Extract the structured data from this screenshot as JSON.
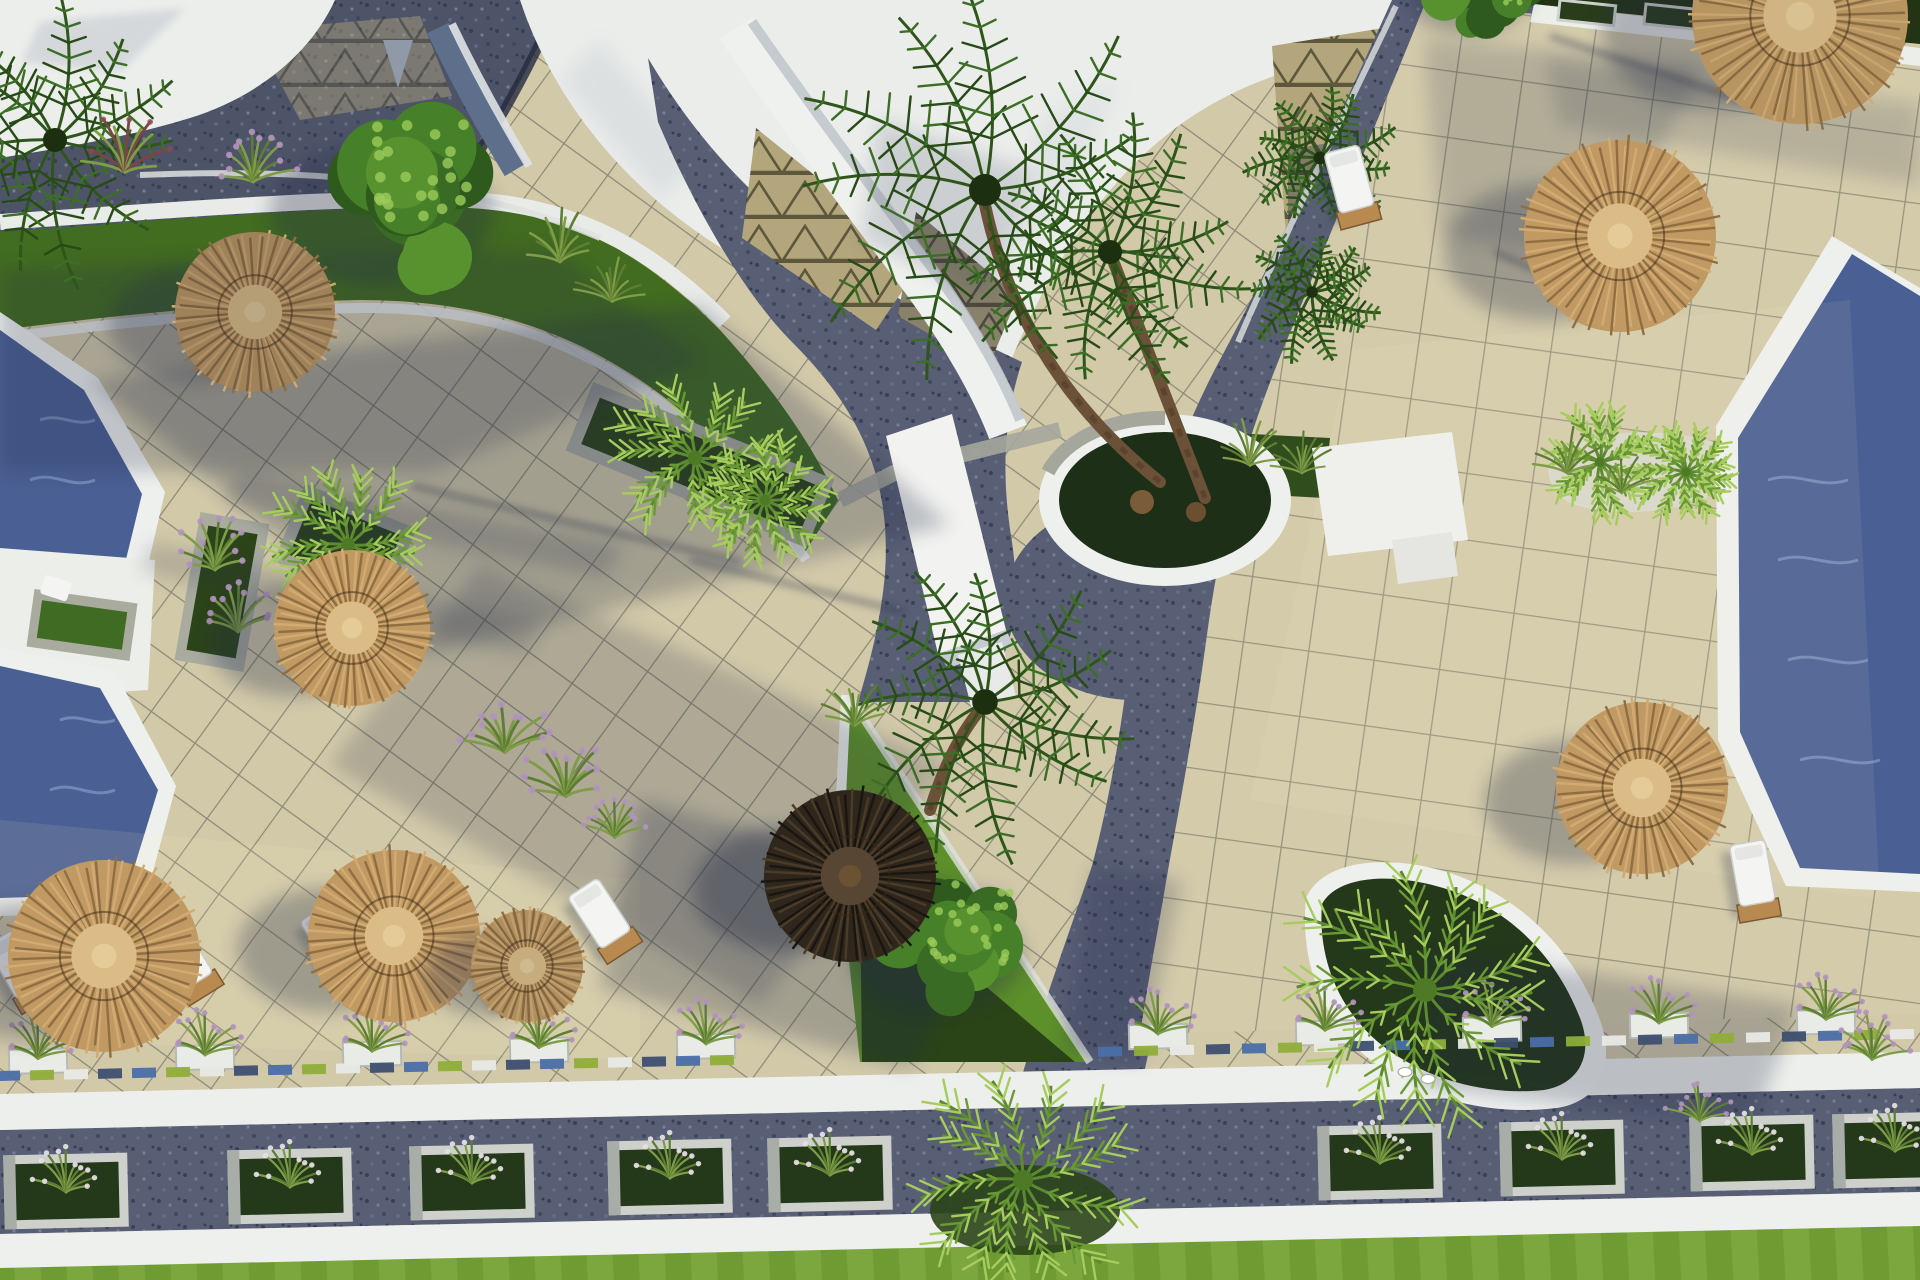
{
  "scene": {
    "type": "aerial-3d-render",
    "description": "Top-down 3D rendering of a resort courtyard with swimming pools, straw parasols, sun loungers, palm trees, planters, beige tiled terraces, dark stone pathways, white curbs and green lawns in low sunlight with long shadows",
    "lighting": "low sun from upper right, long shadows to lower left"
  },
  "colors": {
    "paving": "#d2c9a9",
    "paving_right": "#d4cbab",
    "grid_line": "#5c6052",
    "path": "#585f75",
    "path_deep": "#4e5468",
    "white": "#f1f2ef",
    "white_dim": "#eceee9",
    "white_shade": "#bcc2c8",
    "lawn": "#74a234",
    "lawn_dark": "#426c20",
    "planter_green": "#24381a",
    "bright_green": "#5d8f2b",
    "stone": "#a9ab9f",
    "pool": "#4a5f93",
    "pool_light": "#8ba3cf",
    "straw": "#c19a63",
    "straw_dark": "#8f6f42",
    "straw_mid": "#d2ab72",
    "straw_light": "#dbbc86",
    "umbrella_dark": "#35291b",
    "tree_green": "#3a6b25",
    "palm_green": "#3c6e26",
    "fan_green": "#7fae3f",
    "tri_paving": "#b3a67c",
    "tri_line": "#5d573c",
    "shadow": "#232b47",
    "accent_blue": "#4a6fa8",
    "accent_lime": "#8fae3a",
    "wood": "#b98a50",
    "flower_purple": "#b493c0",
    "trunk": "#6b5137",
    "gravel": "#d8d6cc"
  },
  "objects": {
    "umbrellas": [
      {
        "x": 255,
        "y": 312,
        "r": 80,
        "kind": "straw",
        "shade": 0.2
      },
      {
        "x": 352,
        "y": 628,
        "r": 78,
        "kind": "straw",
        "shade": 0
      },
      {
        "x": 1620,
        "y": 236,
        "r": 96,
        "kind": "straw",
        "shade": 0
      },
      {
        "x": 1642,
        "y": 788,
        "r": 86,
        "kind": "straw",
        "shade": 0
      },
      {
        "x": 104,
        "y": 956,
        "r": 96,
        "kind": "straw",
        "shade": 0
      },
      {
        "x": 394,
        "y": 936,
        "r": 86,
        "kind": "straw",
        "shade": 0
      },
      {
        "x": 527,
        "y": 966,
        "r": 56,
        "kind": "straw",
        "shade": 0.1
      },
      {
        "x": 1800,
        "y": 16,
        "r": 108,
        "kind": "straw",
        "shade": 0.05
      },
      {
        "x": 850,
        "y": 876,
        "r": 86,
        "kind": "dark",
        "shade": 0
      }
    ],
    "loungers": [
      {
        "x": 18,
        "y": 966,
        "rot": -30
      },
      {
        "x": 183,
        "y": 958,
        "rot": -32
      },
      {
        "x": 333,
        "y": 940,
        "rot": -34
      },
      {
        "x": 498,
        "y": 969,
        "rot": -30
      },
      {
        "x": 601,
        "y": 916,
        "rot": -33
      },
      {
        "x": 1753,
        "y": 876,
        "rot": -10
      },
      {
        "x": 1350,
        "y": 182,
        "rot": -15
      }
    ],
    "trunks": [
      {
        "x1": 1160,
        "y1": 482,
        "cx": 1020,
        "cy": 370,
        "x2": 985,
        "y2": 205
      },
      {
        "x1": 1205,
        "y1": 498,
        "cx": 1140,
        "cy": 330,
        "x2": 1112,
        "y2": 258
      },
      {
        "x1": 930,
        "y1": 810,
        "cx": 950,
        "cy": 745,
        "x2": 983,
        "y2": 706
      }
    ],
    "trees": [
      {
        "x": 405,
        "y": 195,
        "r": 118,
        "kind": "leafy"
      },
      {
        "x": 1480,
        "y": -14,
        "r": 64,
        "kind": "leafy"
      },
      {
        "x": 955,
        "y": 942,
        "r": 92,
        "kind": "leafy"
      },
      {
        "x": 985,
        "y": 190,
        "r": 200,
        "kind": "palm"
      },
      {
        "x": 1110,
        "y": 252,
        "r": 150,
        "kind": "palm"
      },
      {
        "x": 985,
        "y": 702,
        "r": 160,
        "kind": "palm"
      },
      {
        "x": 1320,
        "y": 158,
        "r": 80,
        "kind": "palm"
      },
      {
        "x": 1312,
        "y": 292,
        "r": 72,
        "kind": "palm"
      },
      {
        "x": 55,
        "y": 140,
        "r": 150,
        "kind": "palm"
      },
      {
        "x": 348,
        "y": 545,
        "r": 86,
        "kind": "fan"
      },
      {
        "x": 695,
        "y": 458,
        "r": 90,
        "kind": "fan"
      },
      {
        "x": 765,
        "y": 500,
        "r": 68,
        "kind": "fan"
      },
      {
        "x": 1023,
        "y": 1180,
        "r": 125,
        "kind": "fan"
      },
      {
        "x": 1425,
        "y": 990,
        "r": 150,
        "kind": "fan"
      },
      {
        "x": 1600,
        "y": 462,
        "r": 62,
        "kind": "fan"
      },
      {
        "x": 1686,
        "y": 472,
        "r": 56,
        "kind": "fan"
      }
    ],
    "tufts": [
      {
        "x": 125,
        "y": 168,
        "s": 1.1,
        "k": "red"
      },
      {
        "x": 253,
        "y": 178,
        "s": 1.0,
        "k": "purple"
      },
      {
        "x": 560,
        "y": 258,
        "s": 1.0,
        "k": "green"
      },
      {
        "x": 612,
        "y": 298,
        "s": 0.9,
        "k": "green"
      },
      {
        "x": 215,
        "y": 566,
        "s": 1.0,
        "k": "purple"
      },
      {
        "x": 238,
        "y": 628,
        "s": 1.0,
        "k": "purple"
      },
      {
        "x": 505,
        "y": 748,
        "s": 1.1,
        "k": "purple"
      },
      {
        "x": 566,
        "y": 792,
        "s": 1.1,
        "k": "purple"
      },
      {
        "x": 615,
        "y": 834,
        "s": 0.9,
        "k": "purple"
      },
      {
        "x": 1250,
        "y": 462,
        "s": 0.9,
        "k": "green"
      },
      {
        "x": 1302,
        "y": 470,
        "s": 0.8,
        "k": "green"
      },
      {
        "x": 1568,
        "y": 470,
        "s": 0.9,
        "k": "green"
      },
      {
        "x": 1622,
        "y": 490,
        "s": 0.8,
        "k": "green"
      },
      {
        "x": 855,
        "y": 722,
        "s": 0.9,
        "k": "green"
      },
      {
        "x": 1872,
        "y": 1056,
        "s": 0.9,
        "k": "purple"
      },
      {
        "x": 1700,
        "y": 1118,
        "s": 0.8,
        "k": "purple"
      }
    ],
    "planter_row_top": {
      "xs": [
        38,
        205,
        372,
        539,
        706,
        1158,
        1325,
        1492,
        1659,
        1826
      ],
      "y0": 1060,
      "slope": 0.022
    },
    "path_boxes": [
      {
        "x": 66,
        "y": 1191
      },
      {
        "x": 290,
        "y": 1186
      },
      {
        "x": 472,
        "y": 1182
      },
      {
        "x": 670,
        "y": 1177
      },
      {
        "x": 830,
        "y": 1174
      },
      {
        "x": 1380,
        "y": 1162
      },
      {
        "x": 1562,
        "y": 1158
      },
      {
        "x": 1752,
        "y": 1153
      },
      {
        "x": 1895,
        "y": 1150
      }
    ],
    "accent_segments": [
      {
        "from": 8,
        "to": 735,
        "step": 34,
        "y0": 1076,
        "slope": 0.022
      },
      {
        "from": 1110,
        "to": 1905,
        "step": 36,
        "y0": 1076,
        "slope": 0.022
      }
    ],
    "curb_boxes": [
      {
        "x": 1560,
        "y": 0
      },
      {
        "x": 1646,
        "y": 4
      },
      {
        "x": 1732,
        "y": 9
      }
    ],
    "soft_shadows": [
      {
        "pts": "90,380 700,305 950,525 420,655",
        "o": 0.26
      },
      {
        "pts": "480,565 950,765 760,1005 330,765",
        "o": 0.2
      },
      {
        "pts": "640,800 1010,898 910,1068 600,988",
        "o": 0.26
      },
      {
        "pts": "1424,40 1705,62 1600,265 1440,235",
        "o": 0.18
      },
      {
        "pts": "1430,950 1800,1005 1752,1126 1420,1086",
        "o": 0.24
      },
      {
        "pts": "1545,58 1920,104 1920,185 1560,125",
        "o": 0.16
      },
      {
        "pts": "240,470 625,545 605,578 222,502",
        "o": 0.2
      },
      {
        "pts": "150,542 545,622 525,656 140,572",
        "o": 0.17
      },
      {
        "pts": "0,268 555,248 702,362 432,472 0,472",
        "o": 0.22
      },
      {
        "pts": "1092,868 1182,880 1142,1062 1062,1052",
        "o": 0.22
      },
      {
        "pts": "880,120 1030,170 990,300 860,240",
        "o": 0.15
      }
    ],
    "pole_shadows": [
      {
        "x1": 1495,
        "y1": 252,
        "x2": 1628,
        "y2": 310
      },
      {
        "x1": 1550,
        "y1": 36,
        "x2": 1772,
        "y2": 110
      },
      {
        "x1": 412,
        "y1": 486,
        "x2": 742,
        "y2": 562
      },
      {
        "x1": 690,
        "y1": 560,
        "x2": 905,
        "y2": 612
      }
    ],
    "birds": [
      {
        "x": 1405,
        "y": 1072
      },
      {
        "x": 1428,
        "y": 1079
      }
    ]
  }
}
